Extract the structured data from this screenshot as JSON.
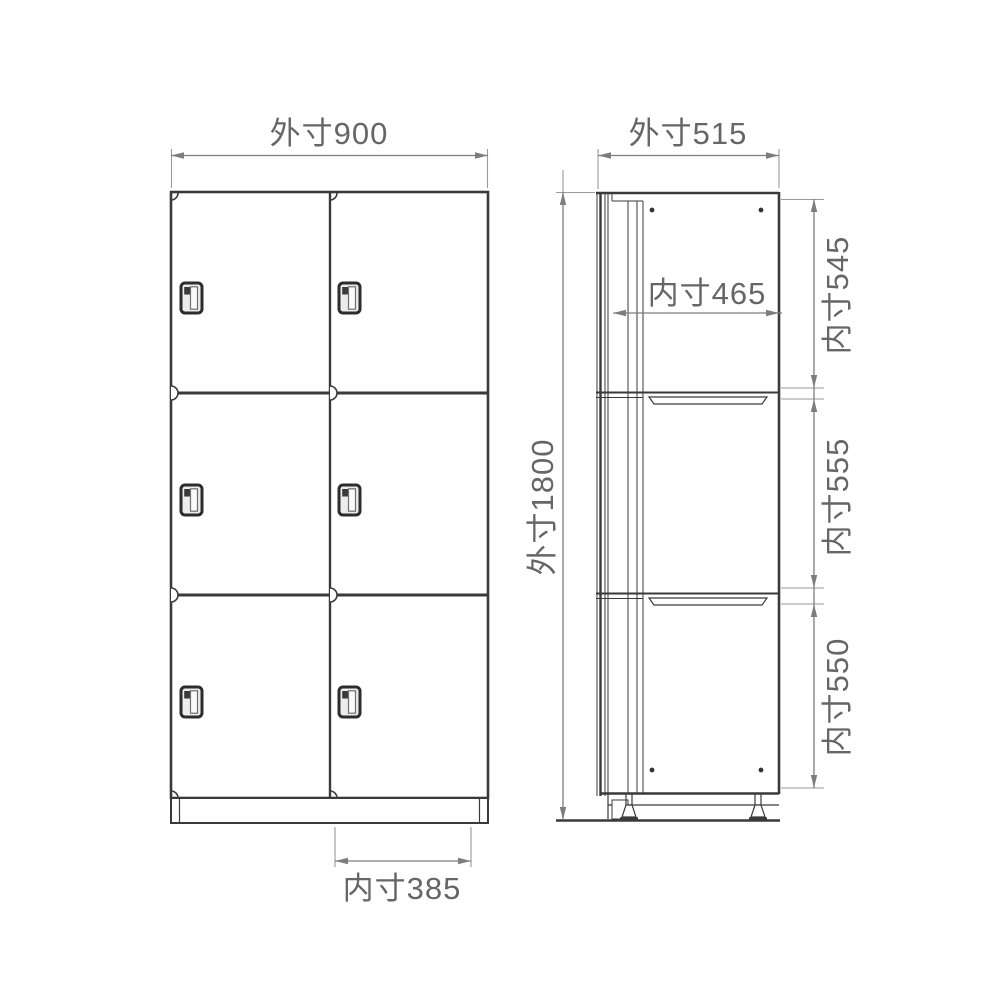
{
  "drawing": {
    "type": "furniture-dimension-diagram",
    "subject": "6-door locker cabinet (2 columns x 3 rows), front view and side view",
    "front_view": {
      "dim_outer_width": "外寸900",
      "dim_inner_width": "内寸385",
      "columns": 2,
      "rows": 3,
      "door_count": 6
    },
    "side_view": {
      "dim_outer_depth": "外寸515",
      "dim_outer_height": "外寸1800",
      "dim_inner_depth": "内寸465",
      "dim_inner_heights": [
        "内寸545",
        "内寸555",
        "内寸550"
      ]
    },
    "colors": {
      "outline": "#3a3a3a",
      "dimension_line": "#7d7d7d",
      "extension_line": "#9a9a9a",
      "text": "#666666",
      "background": "#ffffff"
    }
  }
}
